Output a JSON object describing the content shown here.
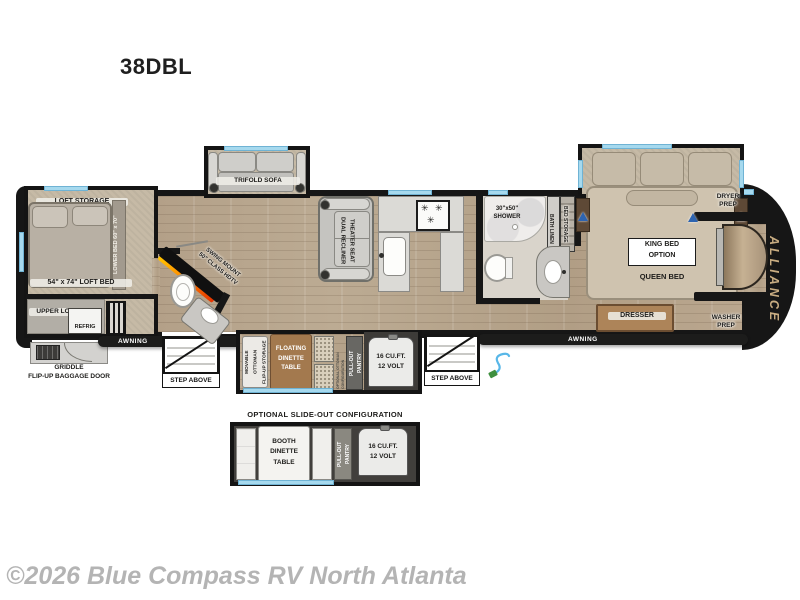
{
  "header": {
    "model": "38DBL"
  },
  "watermark": "©2026 Blue Compass RV North Atlanta",
  "brand": "ALLIANCE",
  "colors": {
    "wall": "#161616",
    "window_accent": "#a6d9ee",
    "floor_wood": "#b7a48c",
    "carpet": "#c6baa6",
    "furniture_wood": "#a3794e",
    "fireplace_orange": "#ff8a00",
    "fireplace_red": "#e63300",
    "brand_text": "#c9ad82",
    "watermark_gray": "#b4b4b4"
  },
  "icons": {
    "burner": "✳"
  },
  "plan": {
    "loft_storage": "LOFT STORAGE",
    "lower_bed": "LOWER BED 60\" x 70\"",
    "loft_bed": "54\" x 74\" LOFT BED",
    "upper_loft": "UPPER LOFT",
    "refrig": "REFRIG",
    "griddle_line1": "GRIDDLE",
    "griddle_line2": "FLIP-UP BAGGAGE DOOR",
    "awning": "AWNING",
    "step_above": "STEP ABOVE",
    "trifold_sofa": "TRIFOLD SOFA",
    "swing_mount_line1": "SWING MOUNT",
    "swing_mount_line2": "50\" CLASS HDTV",
    "theater_line1": "DUAL RECLINER",
    "theater_line2": "THEATER SEAT",
    "shower_line1": "30\"x50\"",
    "shower_line2": "SHOWER",
    "bath_linen": "BATH LINEN",
    "bed_storage": "BED STORAGE",
    "king_bed_line1": "KING BED",
    "king_bed_line2": "OPTION",
    "queen_bed": "QUEEN BED",
    "dresser": "DRESSER",
    "dryer_line1": "DRYER",
    "dryer_line2": "PREP",
    "washer_line1": "WASHER",
    "washer_line2": "PREP",
    "movable_ottoman_line1": "MOVABLE OTTOMAN",
    "movable_ottoman_line2": "FLIP-UP STORAGE",
    "dinette_line1": "FLOATING",
    "dinette_line2": "DINETTE",
    "dinette_line3": "TABLE",
    "optional_ottoman_line1": "OPTIONAL OTTOMAN",
    "optional_ottoman_line2": "CONFIGURATION",
    "pantry_line1": "PULL-OUT",
    "pantry_line2": "PANTRY",
    "fridge_line1": "16 CU.FT.",
    "fridge_line2": "12 VOLT"
  },
  "optional_section": {
    "title": "OPTIONAL SLIDE-OUT CONFIGURATION",
    "booth_line1": "BOOTH",
    "booth_line2": "DINETTE",
    "booth_line3": "TABLE",
    "pantry_line1": "PULL-OUT",
    "pantry_line2": "PANTRY",
    "fridge_line1": "16 CU.FT.",
    "fridge_line2": "12 VOLT"
  }
}
